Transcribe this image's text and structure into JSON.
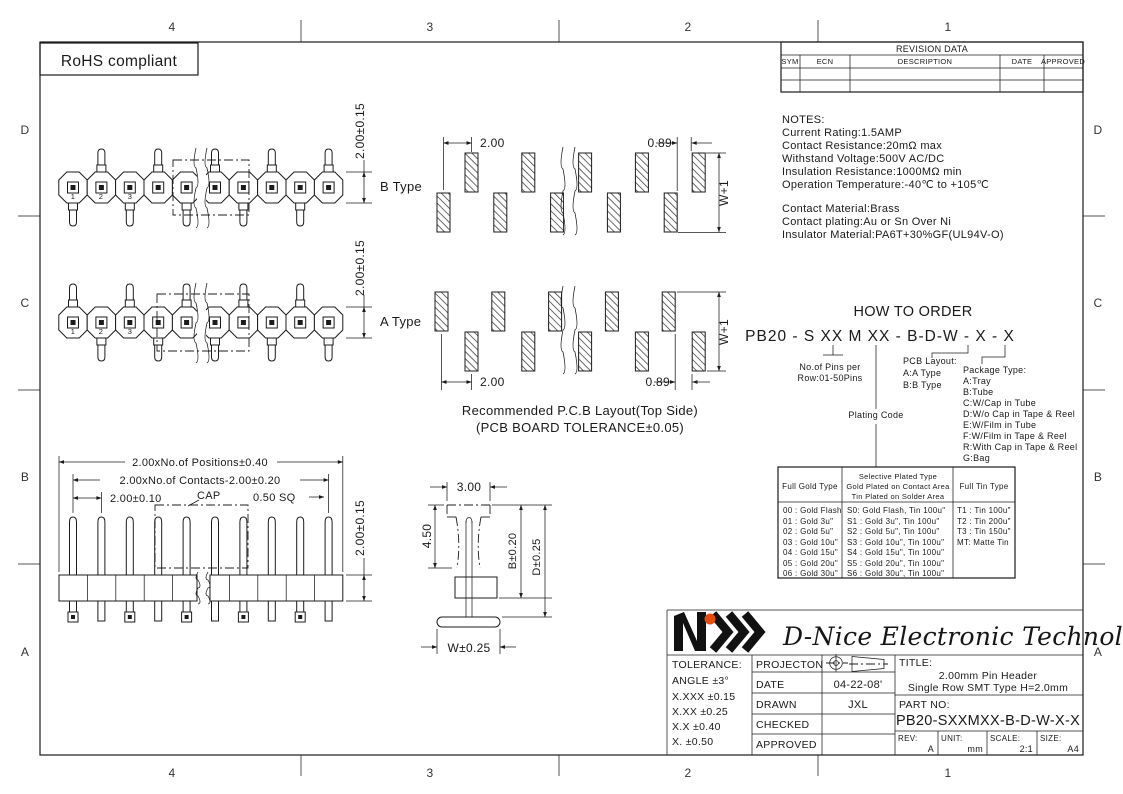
{
  "frame": {
    "top_labels": [
      "4",
      "3",
      "2",
      "1"
    ],
    "bottom_labels": [
      "4",
      "3",
      "2",
      "1"
    ],
    "left_labels": [
      "D",
      "C",
      "B",
      "A"
    ],
    "right_labels": [
      "D",
      "C",
      "B",
      "A"
    ]
  },
  "rohs": {
    "label": "RoHS compliant"
  },
  "revision_table": {
    "title": "REVISION DATA",
    "columns": [
      "SYM",
      "ECN",
      "DESCRIPTION",
      "DATE",
      "APPROVED"
    ]
  },
  "notes": {
    "title": "NOTES:",
    "lines": [
      "Current Rating:1.5AMP",
      "Contact Resistance:20mΩ max",
      "Withstand Voltage:500V AC/DC",
      "Insulation Resistance:1000MΩ min",
      "Operation Temperature:-40℃ to +105℃"
    ],
    "material_lines": [
      "Contact Material:Brass",
      "Contact plating:Au or Sn Over Ni",
      "Insulator Material:PA6T+30%GF(UL94V-O)"
    ]
  },
  "how_to_order": {
    "title": "HOW TO ORDER",
    "part_code": "PB20 - S XX M XX - B-D-W - X - X",
    "pins_note_line1": "No.of Pins per",
    "pins_note_line2": "Row:01-50Pins",
    "plating_code_label": "Plating Code",
    "pcb_layout": [
      "PCB Layout:",
      "A:A Type",
      "B:B Type"
    ],
    "package_type": [
      "Package Type:",
      "A:Tray",
      "B:Tube",
      "C:W/Cap in Tube",
      "D:W/o Cap in Tape & Reel",
      "E:W/Film in Tube",
      "F:W/Film in Tape & Reel",
      "R:With Cap in Tape & Reel",
      "G:Bag"
    ]
  },
  "plating_table": {
    "header_full_gold": "Full Gold Type",
    "header_selective": [
      "Selective Plated Type",
      "Gold Plated on Contact Area",
      "Tin Plated on Solder Area"
    ],
    "header_full_tin": "Full Tin Type",
    "full_gold": [
      "00 : Gold Flash",
      "01 : Gold 3u\"",
      "02 : Gold 5u\"",
      "03 : Gold 10u\"",
      "04 : Gold 15u\"",
      "05 : Gold 20u\"",
      "06 : Gold 30u\""
    ],
    "selective": [
      "S0: Gold Flash, Tin 100u\"",
      "S1 : Gold 3u\", Tin 100u\"",
      "S2 : Gold 5u\", Tin 100u\"",
      "S3 : Gold 10u\", Tin 100u\"",
      "S4 : Gold 15u\", Tin 100u\"",
      "S5 : Gold 20u\", Tin 100u\"",
      "S6 : Gold 30u\", Tin 100u\""
    ],
    "full_tin": [
      "T1 : Tin 100u\"",
      "T2 : Tin 200u\"",
      "T3 : Tin 150u\"",
      "MT: Matte Tin"
    ]
  },
  "drawings": {
    "b_type_label": "B Type",
    "a_type_label": "A Type",
    "pin_numbers": [
      "1",
      "2",
      "3"
    ],
    "dim_row_height": "2.00±0.15",
    "dim_pitch": "2.00",
    "dim_edge": "0.89",
    "dim_w_plus_1": "W+1",
    "pcb_note_line1": "Recommended P.C.B Layout(Top Side)",
    "pcb_note_line2": "(PCB BOARD TOLERANCE±0.05)",
    "front_dim_positions": "2.00xNo.of Positions±0.40",
    "front_dim_contacts": "2.00xNo.of Contacts-2.00±0.20",
    "front_dim_pitch": "2.00±0.10",
    "front_cap_label": "CAP",
    "front_dim_square": "0.50 SQ",
    "side_dim_width": "3.00",
    "side_dim_height": "4.50",
    "side_dim_b": "B±0.20",
    "side_dim_d": "D±0.25",
    "side_dim_w": "W±0.25"
  },
  "title_block": {
    "company": "D-Nice Electronic Technology",
    "tolerance_title": "TOLERANCE:",
    "tolerance_lines": [
      "ANGLE ±3°",
      "X.XXX ±0.15",
      "X.XX ±0.25",
      "X.X ±0.40",
      "X. ±0.50"
    ],
    "row_labels": [
      "PROJECTON",
      "DATE",
      "DRAWN",
      "CHECKED",
      "APPROVED"
    ],
    "date_value": "04-22-08'",
    "drawn_value": "JXL",
    "title_label": "TITLE:",
    "title_line1": "2.00mm Pin Header",
    "title_line2": "Single Row SMT Type H=2.0mm",
    "part_no_label": "PART NO:",
    "part_no": "PB20-SXXMXX-B-D-W-X-X",
    "rev_label": "REV:",
    "rev_value": "A",
    "unit_label": "UNIT:",
    "unit_value": "mm",
    "scale_label": "SCALE:",
    "scale_value": "2:1",
    "size_label": "SIZE:",
    "size_value": "A4"
  }
}
